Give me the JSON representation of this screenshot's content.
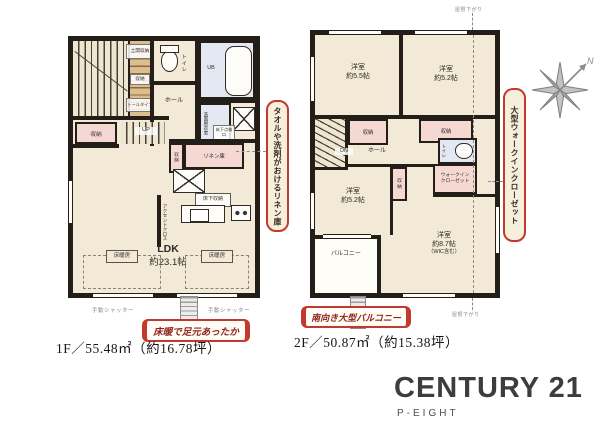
{
  "floor1": {
    "area_label": "1F／55.48㎡（約16.78坪）",
    "badge": "床暖で足元あったか",
    "labels": {
      "doma": "土間収納",
      "shuno_mid": "収納",
      "tall": "トールタイプ",
      "toilet": "トイレ",
      "hall": "ホール",
      "ub": "UB",
      "senmen": "洗面脱衣室",
      "tenken": "床下点検口",
      "shuno_left": "収納",
      "up": "UP",
      "shuno_small": "収納",
      "linen": "リネン庫",
      "yukashita": "床下収納",
      "accent": "アクセントクロス",
      "ldk_name": "LDK",
      "ldk_size": "約23.1帖",
      "yukadan": "床暖房",
      "shutter": "手動シャッター"
    }
  },
  "floor2": {
    "area_label": "2F／50.87㎡（約15.38坪）",
    "badge": "南向き大型バルコニー",
    "labels": {
      "room55_name": "洋室",
      "room55_size": "約5.5帖",
      "room52a_name": "洋室",
      "room52a_size": "約5.2帖",
      "room52b_name": "洋室",
      "room52b_size": "約5.2帖",
      "room87_name": "洋室",
      "room87_size": "約8.7帖",
      "room87_note": "（WIC含む）",
      "shuno": "収納",
      "dn": "DN",
      "hall": "ホール",
      "toilet": "トイレ",
      "wic_line1": "ウォークイン",
      "wic_line2": "クローゼット",
      "balcony": "バルコニー",
      "roof": "屋根下がり"
    }
  },
  "annotations": {
    "linen_badge": "タオルや洗剤がおけるリネン庫",
    "wic_badge": "大型ウォークインクローゼット"
  },
  "compass": {
    "label": "N"
  },
  "brand": {
    "name": "CENTURY 21",
    "tagline": "P-EIGHT"
  }
}
